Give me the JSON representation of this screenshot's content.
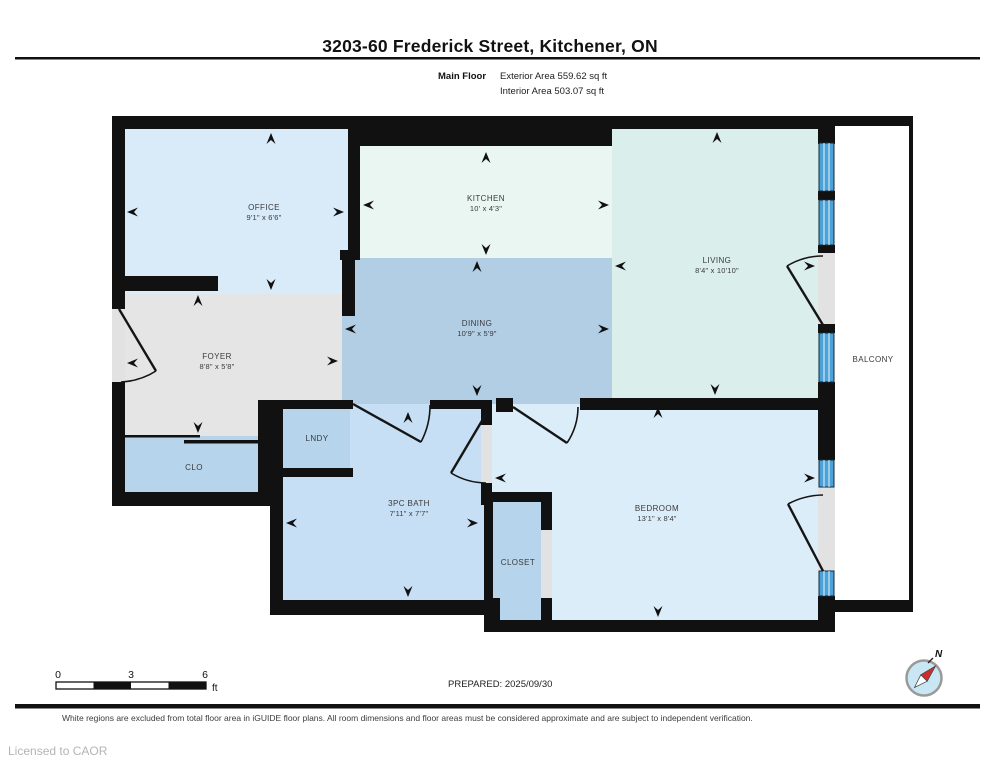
{
  "header": {
    "title": "3203-60 Frederick Street, Kitchener, ON",
    "floor_label": "Main Floor",
    "exterior_area": "Exterior Area 559.62 sq ft",
    "interior_area": "Interior Area 503.07 sq ft"
  },
  "floor_plan": {
    "rooms": {
      "office": {
        "name": "OFFICE",
        "dims": "9'1\" x 6'6\""
      },
      "kitchen": {
        "name": "KITCHEN",
        "dims": "10' x 4'3\""
      },
      "living": {
        "name": "LIVING",
        "dims": "8'4\" x 10'10\""
      },
      "dining": {
        "name": "DINING",
        "dims": "10'9\" x 5'9\""
      },
      "foyer": {
        "name": "FOYER",
        "dims": "8'8\" x 5'8\""
      },
      "bath": {
        "name": "3PC BATH",
        "dims": "7'11\" x 7'7\""
      },
      "bedroom": {
        "name": "BEDROOM",
        "dims": "13'1\" x 8'4\""
      },
      "clo": {
        "name": "CLO"
      },
      "lndy": {
        "name": "LNDY"
      },
      "closet": {
        "name": "CLOSET"
      },
      "balcony": {
        "name": "BALCONY"
      }
    }
  },
  "scale_bar": {
    "start": "0",
    "mid": "3",
    "end": "6",
    "unit": "ft"
  },
  "footer": {
    "prepared": "PREPARED: 2025/09/30",
    "north_label": "N",
    "disclaimer": "White regions are excluded from total floor area in iGUIDE floor plans. All room dimensions and floor areas must be considered approximate and are subject to independent verification.",
    "license": "Licensed to CAOR"
  },
  "colors": {
    "wall": "#111111",
    "office": "#d9eaf8",
    "kitchen": "#e9f6f2",
    "living": "#daeeeb",
    "dining": "#b1cee5",
    "foyer": "#e5e5e6",
    "storage": "#b6d5ec",
    "bath": "#c6dff4",
    "bedroom": "#dcedfa",
    "window": "#4aa2d8",
    "door_opening": "#e2e2e2",
    "compass_face": "#c8e6f4",
    "compass_needle": "#d22b2b"
  }
}
